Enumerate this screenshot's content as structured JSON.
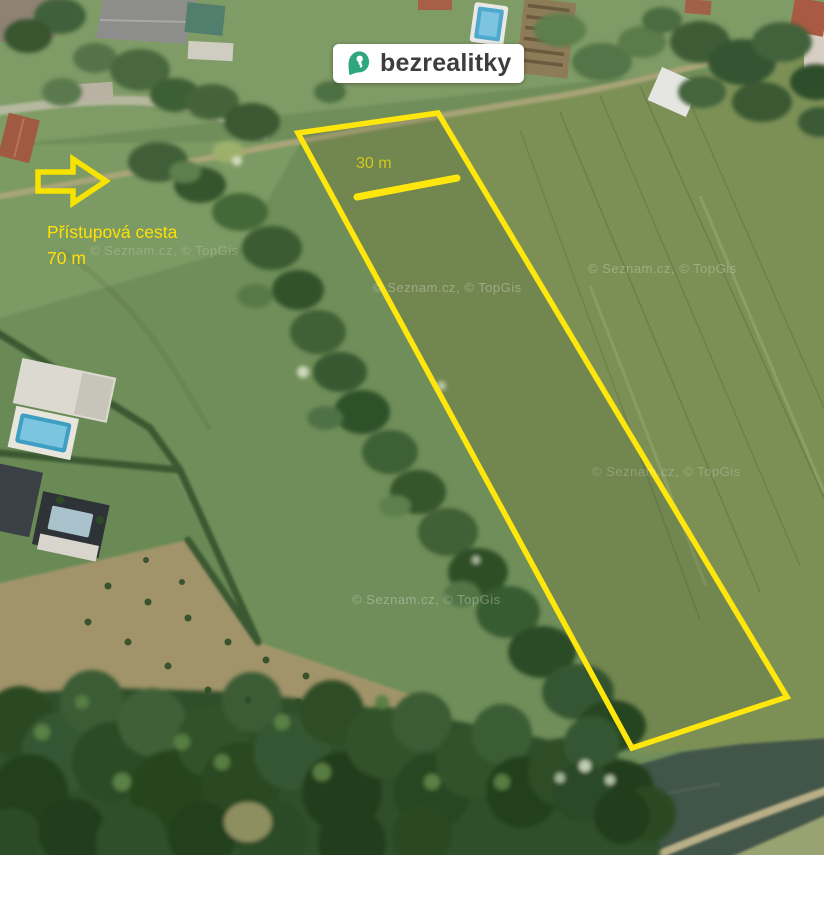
{
  "brand": {
    "name": "bezrealitky",
    "pin_color": "#2fa77e",
    "text_color": "#3d3d3c",
    "badge_bg": "#ffffff"
  },
  "annotations": {
    "access_road_label_line1": "Přístupová cesta",
    "access_road_label_line2": "70 m",
    "measure_label": "30 m",
    "highlight_color": "#ffe70d"
  },
  "map": {
    "watermark": "© Seznam.cz, © TopGis"
  }
}
